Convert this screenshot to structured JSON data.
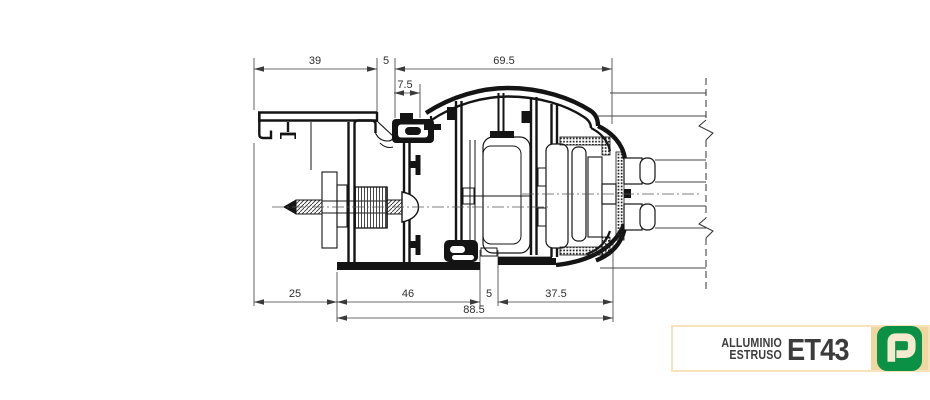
{
  "drawing": {
    "title_semantic": "aluminium-extrusion-cross-section",
    "dims": {
      "top_39": "39",
      "top_5": "5",
      "top_69_5": "69.5",
      "top_7_5": "7.5",
      "bot_25": "25",
      "bot_46": "46",
      "bot_5": "5",
      "bot_37_5": "37.5",
      "bot_88_5": "88.5"
    },
    "colors": {
      "ink": "#141414",
      "dim_lines": "#3a3a3a"
    }
  },
  "badge": {
    "brand_line1": "ALLUMINIO",
    "brand_line2": "ESTRUSO",
    "code": "ET43",
    "logo_letter": "P",
    "colors": {
      "badge-border": "#f6e3bb",
      "badge-text": "#3c3c3c",
      "logo-bg": "#f0d7a2",
      "logo-green": "#0a9146",
      "logo-p": "#f5ead0"
    }
  }
}
